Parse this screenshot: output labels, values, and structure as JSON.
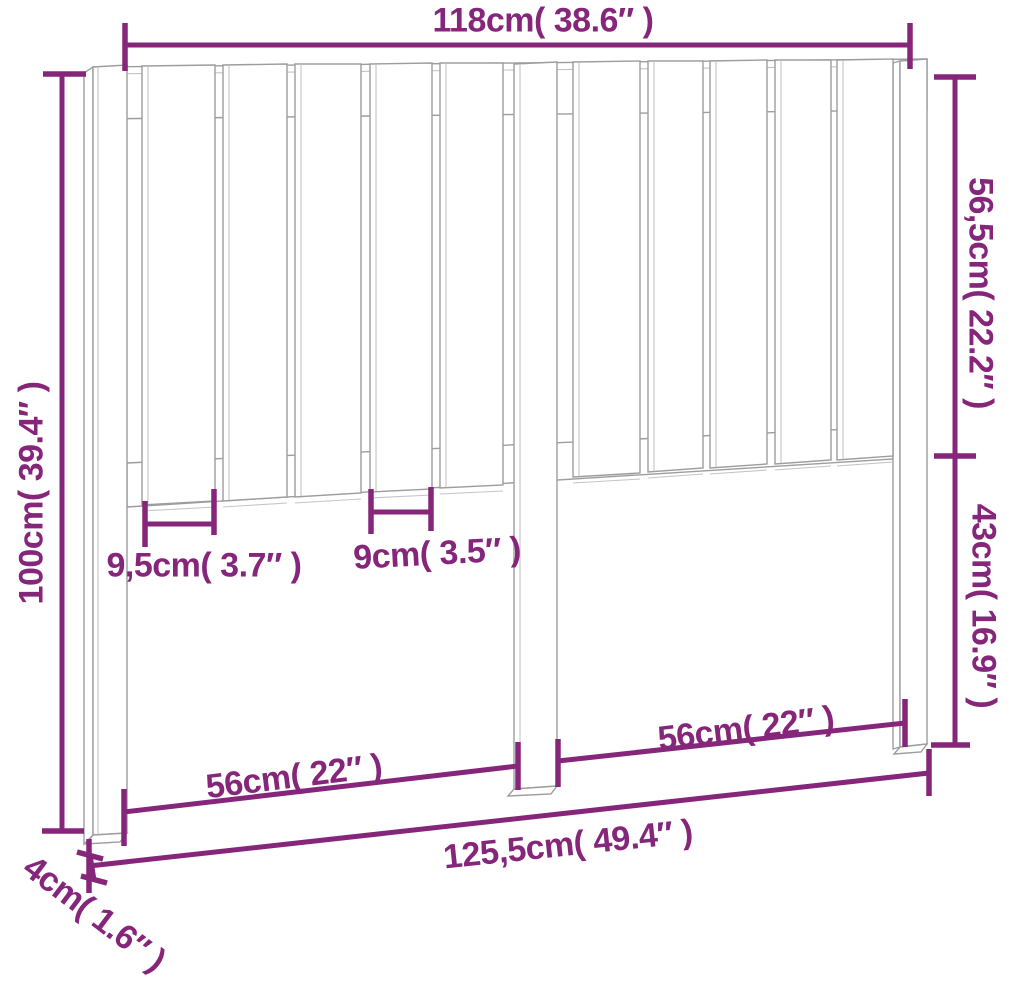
{
  "page": {
    "type": "product-dimension-diagram",
    "subject": "slatted wooden bed headboard with three legs",
    "background_color": "#ffffff",
    "dimension_color": "#85267b",
    "drawing_line_color": "#9d9d9d"
  },
  "dimensions": {
    "width_top": "118cm( 38.6″ )",
    "height_left": "100cm( 39.4″ )",
    "slat_panel_height_right": "56,5cm( 22.2″ )",
    "leg_below_panel_right": "43cm( 16.9″ )",
    "slat_width_left": "9,5cm( 3.7″ )",
    "slat_width_center": "9cm( 3.5″ )",
    "span_left_leg_to_center": "56cm( 22″ )",
    "span_center_to_right_leg": "56cm( 22″ )",
    "width_bottom_overall": "125,5cm( 49.4″ )",
    "leg_thickness": "4cm( 1.6″ )"
  }
}
